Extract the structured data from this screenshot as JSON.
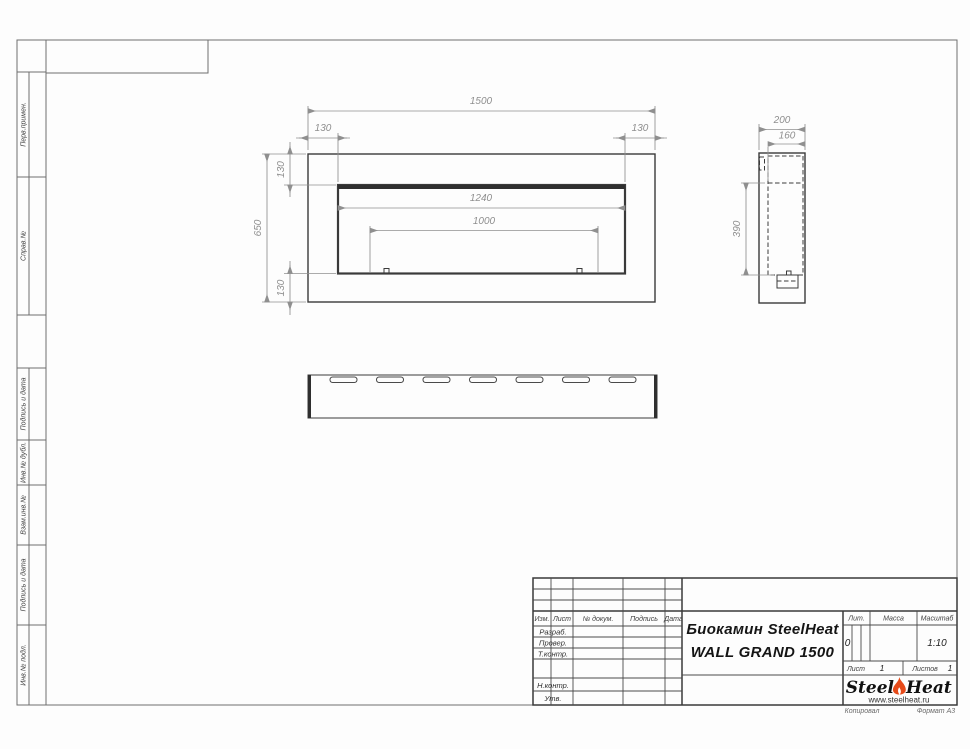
{
  "sheet": {
    "background": "#fdfdfd",
    "footer": {
      "copied_label": "Копировал",
      "format_label": "Формат А3"
    }
  },
  "sidebar": {
    "labels": [
      "Перв.примен.",
      "Справ.№",
      "Подпись и дата",
      "Инв.№ дубл.",
      "Взам.инв.№",
      "Подпись и дата",
      "Инв.№ подл."
    ]
  },
  "views": {
    "front": {
      "dim_width": "1500",
      "dim_left": "130",
      "dim_right": "130",
      "dim_height": "650",
      "dim_top": "130",
      "dim_bottom": "130",
      "dim_opening": "1240",
      "dim_burner": "1000"
    },
    "side": {
      "dim_depth": "200",
      "dim_inset": "160",
      "dim_opening_height": "390"
    },
    "bottom": {
      "slot_count": 7
    }
  },
  "stamp": {
    "columns": {
      "izm": "Изм.",
      "list": "Лист",
      "doc": "№ докум.",
      "sign": "Подпись",
      "date": "Дата"
    },
    "rows": {
      "developed": "Разраб.",
      "checked": "Провер.",
      "tcontrol": "Т.контр.",
      "ncontrol": "Н.контр.",
      "approved": "Утв."
    },
    "title_line1": "Биокамин SteelHeat",
    "title_line2": "WALL GRAND 1500",
    "lit": {
      "label": "Лит.",
      "value": "0"
    },
    "mass": {
      "label": "Масса",
      "value": ""
    },
    "scale": {
      "label": "Масштаб",
      "value": "1:10"
    },
    "sheet_no": {
      "label": "Лист",
      "value": "1"
    },
    "sheets_total": {
      "label": "Листов",
      "value": "1"
    },
    "logo": {
      "word1": "Steel",
      "word2": "Heat",
      "url": "www.steelheat.ru",
      "flame_color": "#e64a19"
    }
  }
}
